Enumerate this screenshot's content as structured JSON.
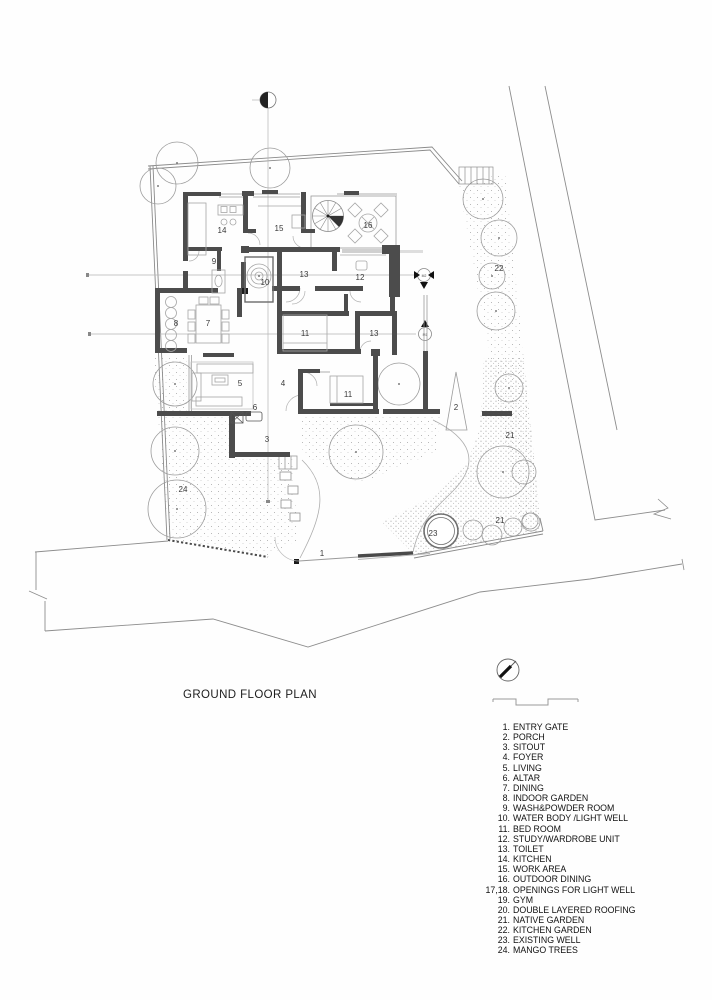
{
  "title": "GROUND FLOOR PLAN",
  "legend": {
    "items": [
      {
        "num": "1.",
        "label": "ENTRY GATE"
      },
      {
        "num": "2.",
        "label": "PORCH"
      },
      {
        "num": "3.",
        "label": "SITOUT"
      },
      {
        "num": "4.",
        "label": "FOYER"
      },
      {
        "num": "5.",
        "label": "LIVING"
      },
      {
        "num": "6.",
        "label": "ALTAR"
      },
      {
        "num": "7.",
        "label": "DINING"
      },
      {
        "num": "8.",
        "label": "INDOOR GARDEN"
      },
      {
        "num": "9.",
        "label": "WASH&POWDER ROOM"
      },
      {
        "num": "10.",
        "label": "WATER BODY /LIGHT WELL"
      },
      {
        "num": "11.",
        "label": "BED ROOM"
      },
      {
        "num": "12.",
        "label": "STUDY/WARDROBE UNIT"
      },
      {
        "num": "13.",
        "label": "TOILET"
      },
      {
        "num": "14.",
        "label": "KITCHEN"
      },
      {
        "num": "15.",
        "label": "WORK AREA"
      },
      {
        "num": "16.",
        "label": "OUTDOOR DINING"
      },
      {
        "num": "17,18.",
        "label": "OPENINGS FOR LIGHT WELL"
      },
      {
        "num": "19.",
        "label": "GYM"
      },
      {
        "num": "20.",
        "label": "DOUBLE LAYERED ROOFING"
      },
      {
        "num": "21.",
        "label": "NATIVE GARDEN"
      },
      {
        "num": "22.",
        "label": "KITCHEN GARDEN"
      },
      {
        "num": "23.",
        "label": "EXISTING WELL"
      },
      {
        "num": "24.",
        "label": "MANGO TREES"
      }
    ]
  },
  "plan_labels": [
    {
      "t": "1",
      "x": 322,
      "y": 556
    },
    {
      "t": "2",
      "x": 456,
      "y": 410
    },
    {
      "t": "3",
      "x": 267,
      "y": 442
    },
    {
      "t": "4",
      "x": 283,
      "y": 386
    },
    {
      "t": "5",
      "x": 240,
      "y": 386
    },
    {
      "t": "6",
      "x": 255,
      "y": 410
    },
    {
      "t": "7",
      "x": 208,
      "y": 326
    },
    {
      "t": "8",
      "x": 176,
      "y": 326
    },
    {
      "t": "9",
      "x": 214,
      "y": 264
    },
    {
      "t": "10",
      "x": 265,
      "y": 285
    },
    {
      "t": "11",
      "x": 305,
      "y": 336
    },
    {
      "t": "11",
      "x": 348,
      "y": 397
    },
    {
      "t": "12",
      "x": 360,
      "y": 280
    },
    {
      "t": "13",
      "x": 304,
      "y": 277
    },
    {
      "t": "13",
      "x": 374,
      "y": 336
    },
    {
      "t": "14",
      "x": 222,
      "y": 233
    },
    {
      "t": "15",
      "x": 279,
      "y": 231
    },
    {
      "t": "16",
      "x": 368,
      "y": 228
    },
    {
      "t": "21",
      "x": 510,
      "y": 438
    },
    {
      "t": "21",
      "x": 500,
      "y": 523
    },
    {
      "t": "22",
      "x": 499,
      "y": 271
    },
    {
      "t": "23",
      "x": 433,
      "y": 536
    },
    {
      "t": "24",
      "x": 183,
      "y": 492
    }
  ],
  "section_markers": {
    "upper": "M2",
    "lower": "M1"
  }
}
